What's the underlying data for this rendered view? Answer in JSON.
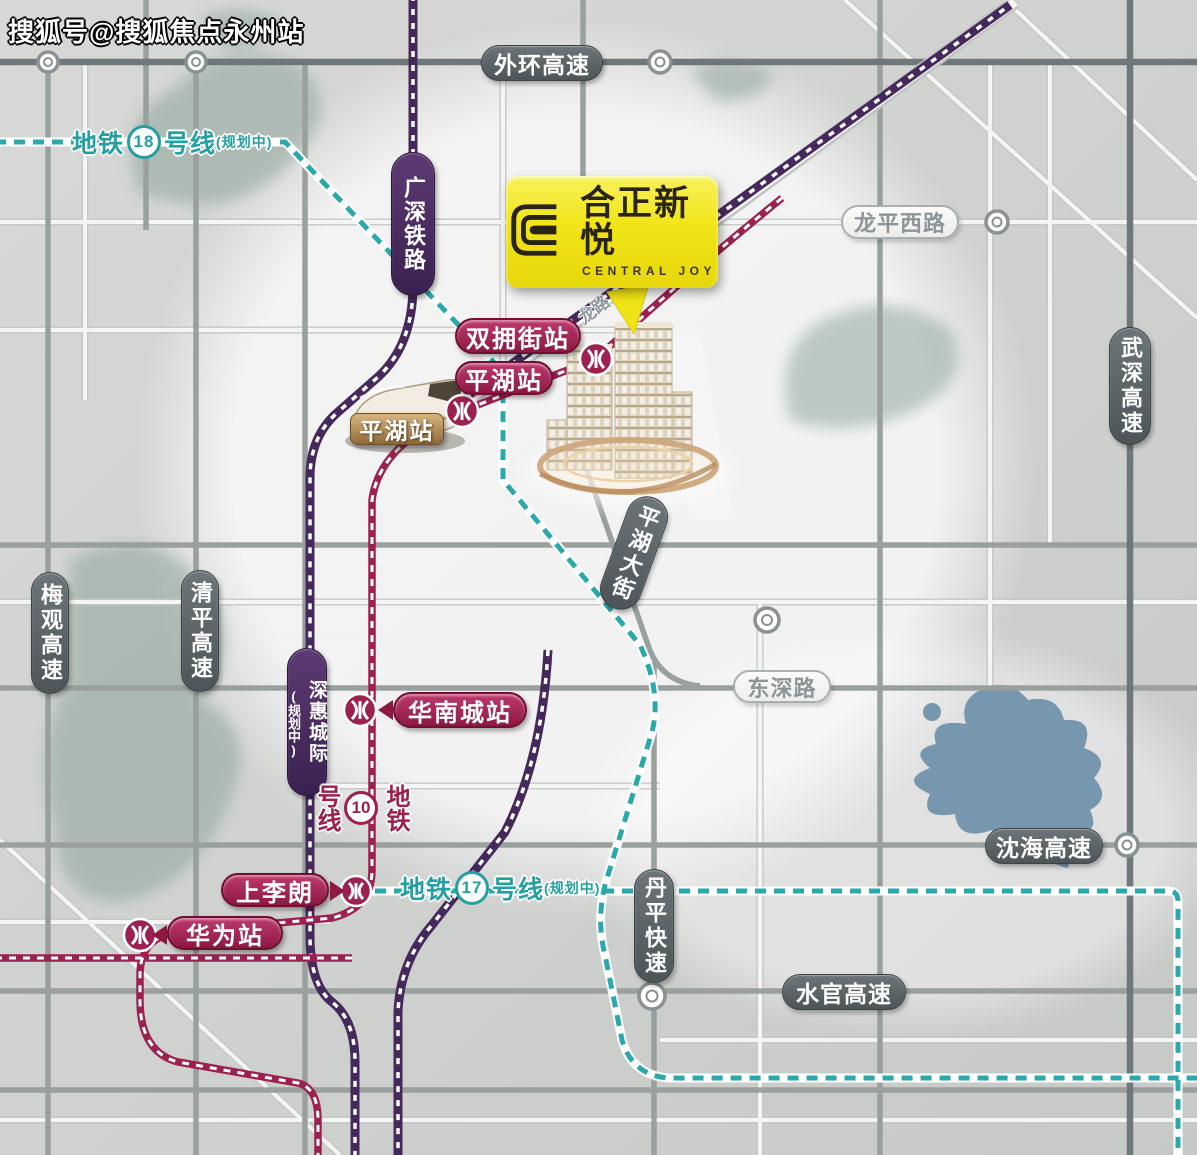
{
  "watermark": "搜狐号@搜狐焦点永州站",
  "project": {
    "logo_cn": "合正新悦",
    "logo_en": "CENTRAL JOY"
  },
  "colors": {
    "metro_teal": "#249fa2",
    "metro_crimson": "#9c1f4e",
    "railway_purple": "#46295c",
    "highway_pill": "#4d5558",
    "logo_yellow": "#f1e416",
    "water_blue": "#6d90a8"
  },
  "highways": {
    "waihuan": "外环高速",
    "meiguan": "梅观高速",
    "qingping": "清平高速",
    "wushen": "武深高速",
    "shenhai": "沈海高速",
    "danping": "丹平快速",
    "shuiguan": "水官高速",
    "pinghu_avenue": "平湖大街"
  },
  "roads": {
    "longping_west": "龙平西路",
    "dongshen": "东深路",
    "long_road": "龙路"
  },
  "railways": {
    "guangshen": "广深铁路",
    "shenhui": {
      "name": "深惠城际",
      "note": "(规划中)"
    }
  },
  "metro_lines": {
    "line18": {
      "prefix": "地铁",
      "number": "18",
      "suffix": "号线",
      "note": "(规划中)"
    },
    "line17": {
      "prefix": "地铁",
      "number": "17",
      "suffix": "号线",
      "note": "(规划中)"
    },
    "line10": {
      "prefix": "地铁",
      "number": "10",
      "suffix": "号线"
    }
  },
  "stations": {
    "shuangyongjie": "双拥街站",
    "pinghu_metro": "平湖站",
    "pinghu_rail": "平湖站",
    "huanancheng": "华南城站",
    "shanglilang": "上李朗",
    "huawei": "华为站"
  }
}
